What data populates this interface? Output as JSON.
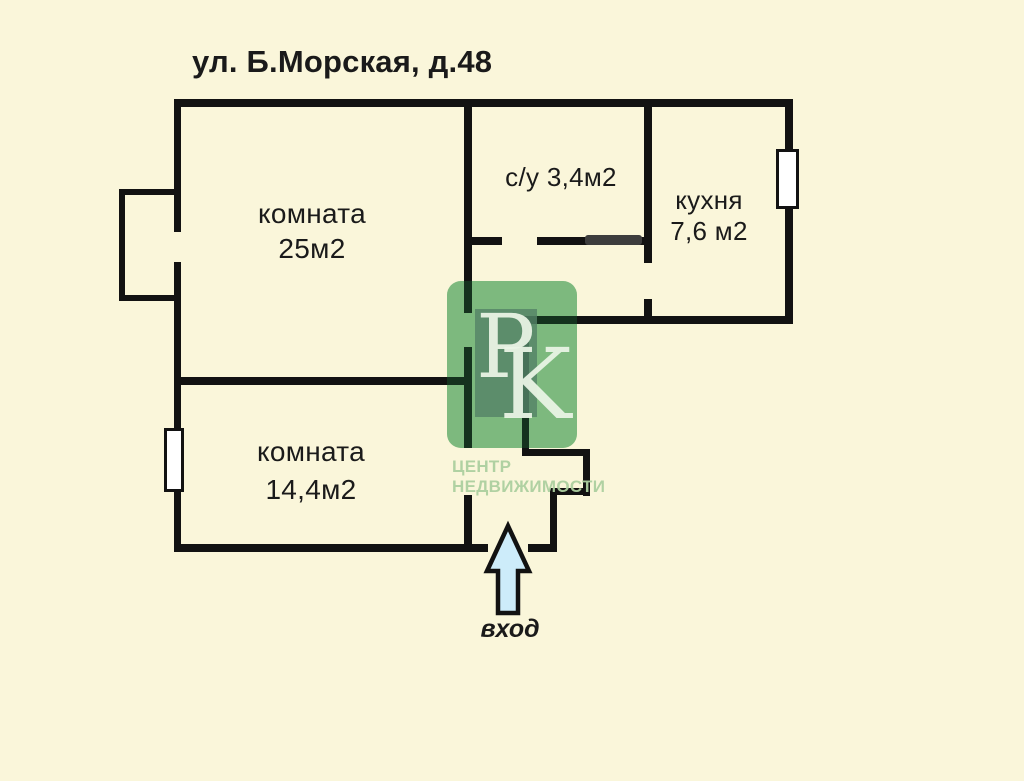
{
  "title": "ул. Б.Морская, д.48",
  "rooms": [
    {
      "name": "комната",
      "area": "25м2"
    },
    {
      "name": "с/у",
      "area": "3,4м2"
    },
    {
      "name": "кухня",
      "area": "7,6 м2"
    },
    {
      "name": "комната",
      "area": "14,4м2"
    }
  ],
  "entrance": {
    "label": "вход",
    "arrow_icon": "up-arrow"
  },
  "watermark": {
    "letter_p": "P",
    "letter_k": "K",
    "tagline_line1": "ЦЕНТР",
    "tagline_line2": "НЕДВИЖИМОСТИ"
  },
  "colors": {
    "background": "#faf6da",
    "wall": "#121212",
    "text": "#1a1a1a",
    "arrow_fill": "#cdecfa",
    "watermark_green": "#9ed2a8",
    "watermark_text": "#add0a0",
    "window_fill": "#ffffff",
    "door_leaf": "#3d3d3d"
  }
}
